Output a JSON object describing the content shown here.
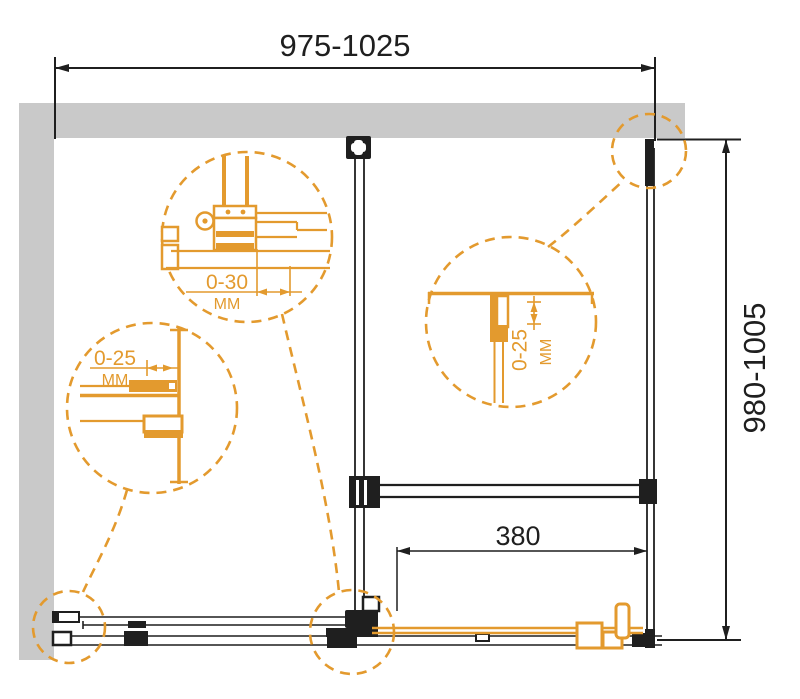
{
  "meta": {
    "type": "technical-drawing",
    "subject": "shower-enclosure-top-view"
  },
  "dimensions": {
    "width_range": "975-1025",
    "depth_range": "980-1005",
    "door_travel": "380"
  },
  "details": {
    "roller": {
      "value": "0-30",
      "unit": "ММ"
    },
    "left_profile": {
      "value": "0-25",
      "unit": "ММ"
    },
    "right_profile": {
      "value": "0-25",
      "unit": "ММ"
    }
  },
  "colors": {
    "accent_orange": "#E39A2E",
    "wall_gray": "#C9C9C9",
    "line_ink": "#1F1F1F",
    "background": "#FFFFFF"
  }
}
